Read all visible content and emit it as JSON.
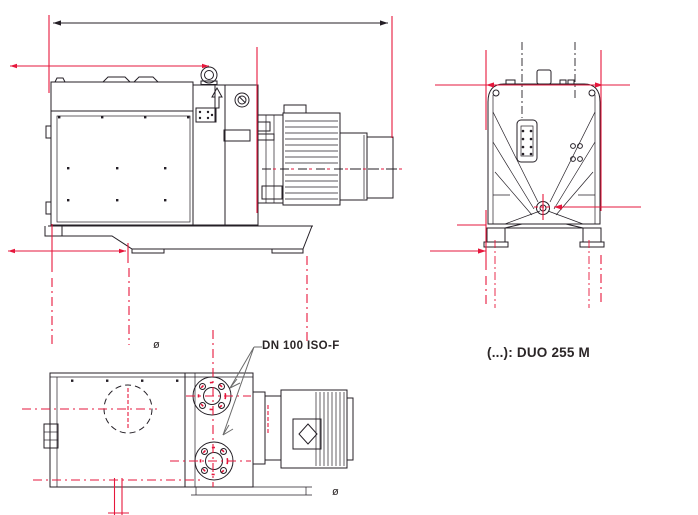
{
  "drawing": {
    "flange_label": "DN 100 ISO-F",
    "caption": "(...): DUO 255 M",
    "diameter_symbol_top": "ø",
    "diameter_symbol_bottom": "ø"
  },
  "colors": {
    "dimension_red": "#e6173c",
    "line_dark": "#241f26",
    "text_dark": "#2b2627",
    "leader_gray": "#6b6b6b",
    "background": "#ffffff"
  }
}
